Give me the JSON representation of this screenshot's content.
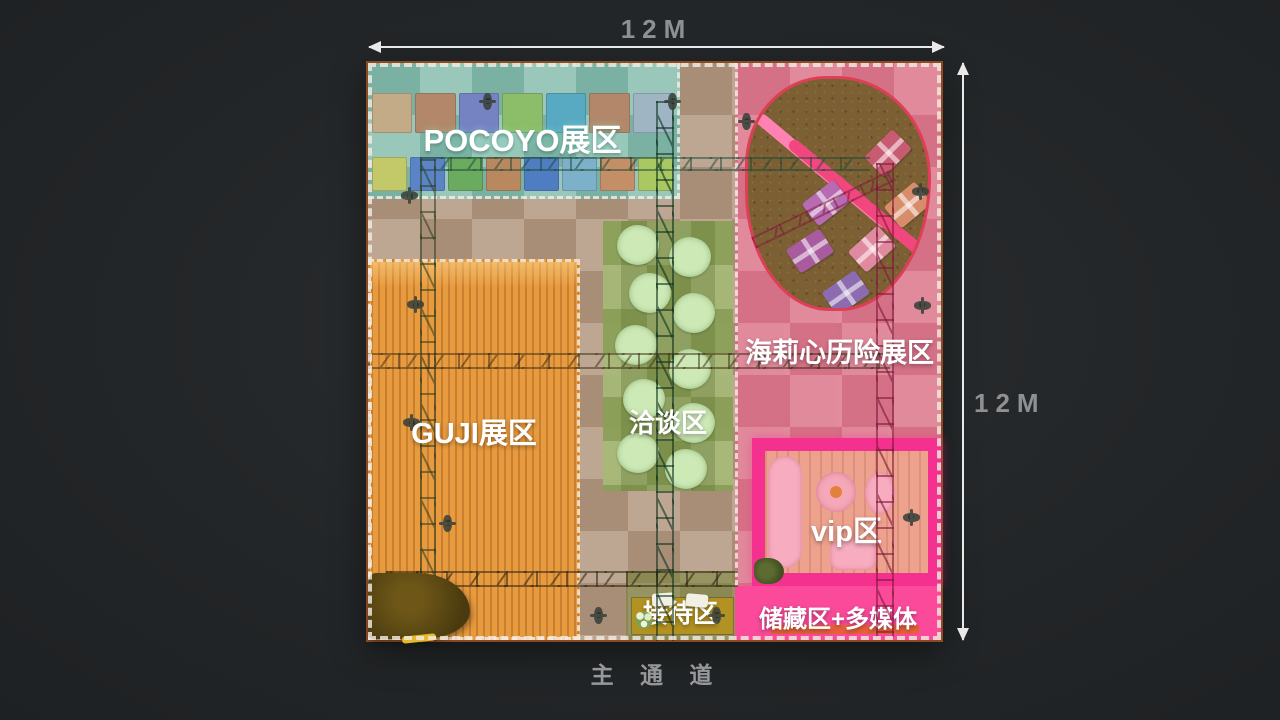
{
  "scene": {
    "aisle_label": "主 通 道"
  },
  "dimensions": {
    "width_label": "12M",
    "height_label": "12M"
  },
  "zones": {
    "pocoyo": {
      "label": "POCOYO展区",
      "color": "#80bfb0"
    },
    "haili": {
      "label": "海莉心历险展区",
      "color": "#e0788e"
    },
    "guji": {
      "label": "GUJI展区",
      "color": "#e79a3e"
    },
    "qiatan": {
      "label": "洽谈区",
      "color": "#96ac5f"
    },
    "vip": {
      "label": "vip区",
      "color": "#f5318f"
    },
    "jiedai": {
      "label": "接待区",
      "color": "#b29222"
    },
    "chucang": {
      "label": "储藏区+多媒体",
      "color": "#fa4a99"
    }
  }
}
